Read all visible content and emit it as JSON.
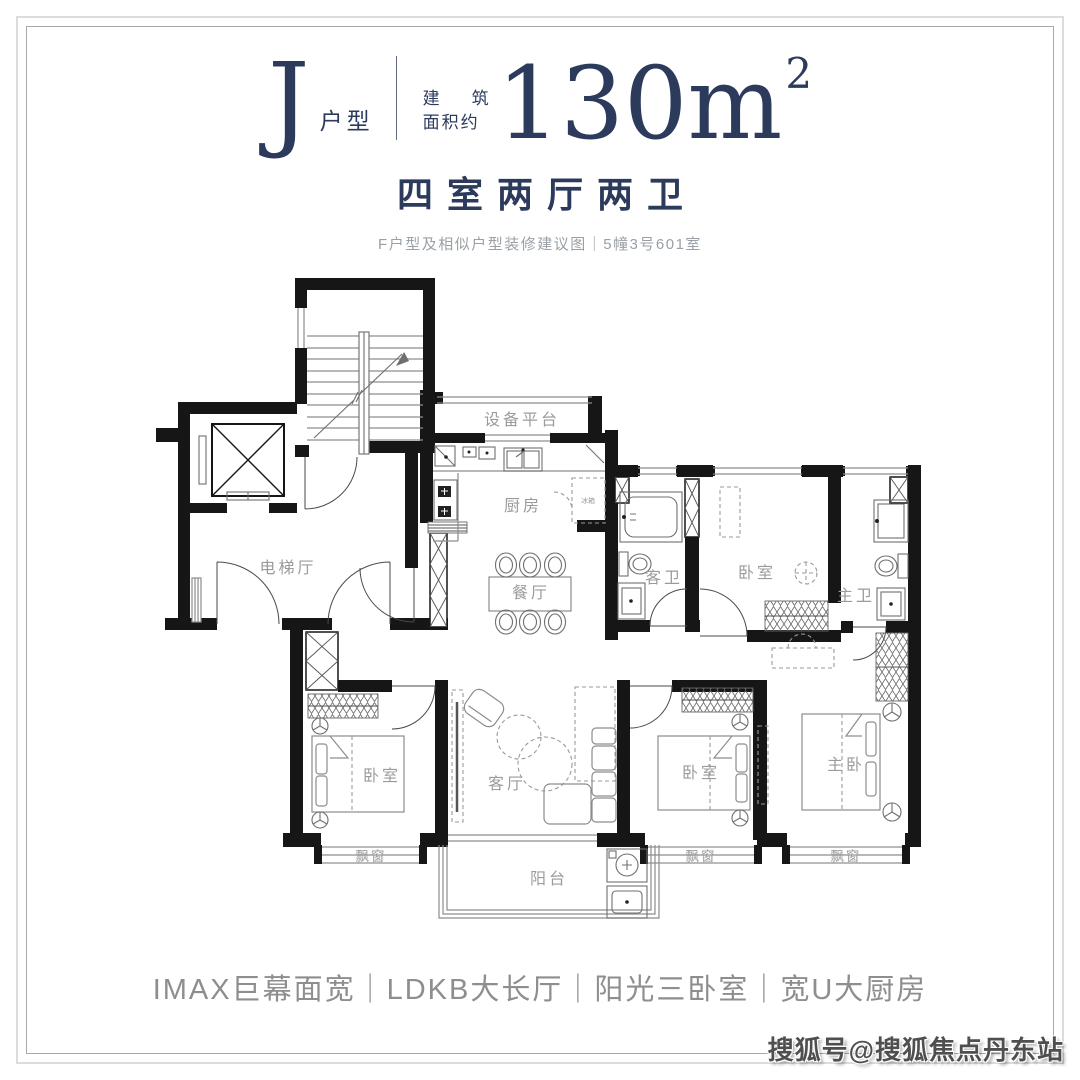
{
  "header": {
    "unit_letter": "J",
    "unit_type_suffix": "户型",
    "area_prefix_line1_a": "建",
    "area_prefix_line1_b": "筑",
    "area_prefix_line2": "面积约",
    "area_value": "130m",
    "area_superscript": "2",
    "layout_line": "四室两厅两卫",
    "note": "F户型及相似户型装修建议图｜5幢3号601室"
  },
  "plan": {
    "labels": {
      "equipment_platform": "设备平台",
      "kitchen": "厨房",
      "fridge": "冰箱",
      "dining_room": "餐厅",
      "elevator_hall": "电梯厅",
      "guest_bathroom": "客卫",
      "bedroom_top": "卧室",
      "master_bathroom": "主卫",
      "bedroom_left": "卧室",
      "living_room": "客厅",
      "bedroom_right": "卧室",
      "master_bedroom": "主卧",
      "bay_window_left": "飘窗",
      "bay_window_mid": "飘窗",
      "bay_window_right": "飘窗",
      "balcony": "阳台"
    }
  },
  "footer": {
    "features": "IMAX巨幕面宽｜LDKB大长厅｜阳光三卧室｜宽U大厨房"
  },
  "watermark": "搜狐号@搜狐焦点丹东站",
  "colors": {
    "navy": "#2c3a5c",
    "wall_black": "#161616",
    "furniture_gray": "#8d8d8d",
    "label_gray": "#9b9b9b",
    "note_gray": "#9aa0a6",
    "features_gray": "#8e8e8e",
    "watermark_gray": "#4f4f4f"
  }
}
